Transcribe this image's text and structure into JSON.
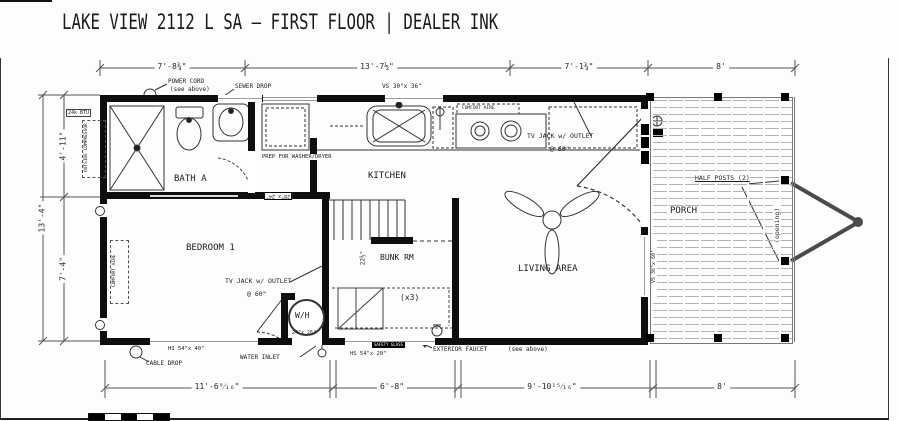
{
  "title": "LAKE VIEW 2112 L SA – FIRST FLOOR | DEALER INK",
  "dims": {
    "top": [
      "7'-8¾\"",
      "13'-7½\"",
      "7'-1¾\"",
      "8'"
    ],
    "bottom": [
      "11'-6⁹⁄₁₆\"",
      "6'-8\"",
      "9'-10¹⁵⁄₁₆\"",
      "8'"
    ],
    "left_overall": "13'-4\"",
    "left_upper": "4'-11\"",
    "left_lower": "7'-4\"",
    "stair": "22½\""
  },
  "rooms": {
    "bath": "BATH A",
    "bedroom": "BEDROOM 1",
    "kitchen": "KITCHEN",
    "living": "LIVING AREA",
    "bunk": "BUNK RM",
    "bunk_qty": "(x3)",
    "porch": "PORCH",
    "water_heater": "W/H"
  },
  "annotations": {
    "power_cord": "POWER CORD",
    "power_cord_note": "(see above)",
    "sewer_drop": "SEWER DROP",
    "kitchen_window": "VS 30\"x 36\"",
    "range_brand": "COMFORT AIRE",
    "tv_jack": "TV JACK w/ OUTLET",
    "tv_jack_height": "@ 60\"",
    "prep_wd": "PREP FOR WASHER/DRYER",
    "compressor": "OUTSIDE COMPRESSOR",
    "compressor_btu": "24k BTU",
    "bedroom_ac": "COMFORT AIRE",
    "half_posts": "HALF POSTS (2)",
    "opening": "(opening)",
    "porch_window": "VS 36\"x 60\"",
    "bedroom_window": "HS 54\"x 40\"",
    "bunk_window": "HS 54\"x 20\"",
    "safety_glass": "SAFETY GLASS",
    "cable_drop": "CABLE DROP",
    "water_inlet": "WATER INLET",
    "exterior_faucet": "EXTERIOR FAUCET",
    "exterior_faucet_note": "(see above)",
    "wall_access": "28\"x 24\"",
    "wh_access": "24\"x 26\""
  }
}
